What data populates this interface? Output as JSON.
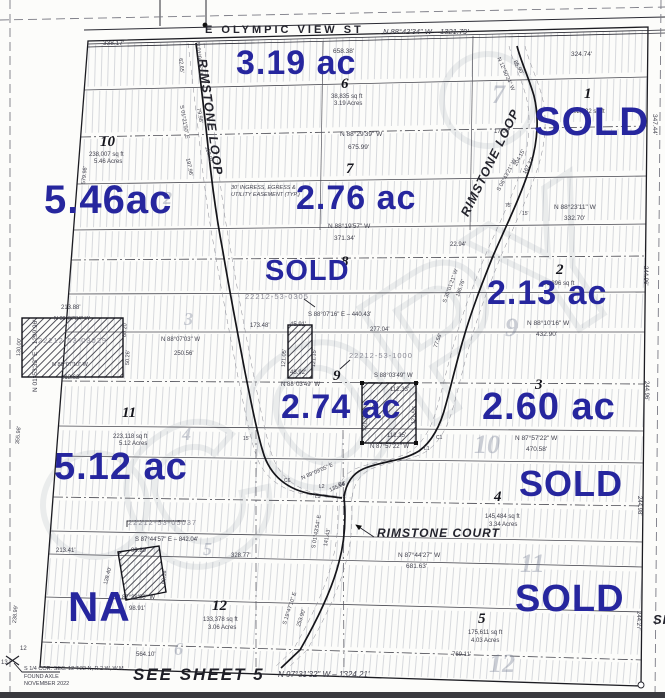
{
  "map": {
    "watermark": "COPY",
    "colors": {
      "annotation_blue": "#26269e",
      "line_dark": "#23232c",
      "hatch_gray": "#9aa0ad"
    },
    "streets": {
      "top_street": "E OLYMPIC VIEW ST",
      "loop": "RIMSTONE LOOP",
      "court": "RIMSTONE COURT"
    },
    "acreage_notes": [
      {
        "t": "3.19 ac",
        "x": 236,
        "y": 46,
        "s": 34
      },
      {
        "t": "SOLD",
        "x": 534,
        "y": 102,
        "s": 40
      },
      {
        "t": "5.46ac",
        "x": 44,
        "y": 180,
        "s": 40
      },
      {
        "t": "2.76 ac",
        "x": 296,
        "y": 181,
        "s": 34
      },
      {
        "t": "SOLD",
        "x": 265,
        "y": 257,
        "s": 29
      },
      {
        "t": "2.13 ac",
        "x": 487,
        "y": 276,
        "s": 34
      },
      {
        "t": "2.74 ac",
        "x": 281,
        "y": 390,
        "s": 34
      },
      {
        "t": "2.60 ac",
        "x": 482,
        "y": 388,
        "s": 38
      },
      {
        "t": "5.12 ac",
        "x": 54,
        "y": 448,
        "s": 38
      },
      {
        "t": "SOLD",
        "x": 519,
        "y": 466,
        "s": 36
      },
      {
        "t": "NA",
        "x": 68,
        "y": 586,
        "s": 42
      },
      {
        "t": "SOLD",
        "x": 515,
        "y": 580,
        "s": 38
      }
    ],
    "lot_numbers": [
      {
        "t": "10",
        "x": 100,
        "y": 135,
        "s": 15
      },
      {
        "t": "6",
        "x": 341,
        "y": 77,
        "s": 15
      },
      {
        "t": "1",
        "x": 584,
        "y": 87,
        "s": 15
      },
      {
        "t": "7",
        "x": 346,
        "y": 162,
        "s": 15
      },
      {
        "t": "8",
        "x": 341,
        "y": 255,
        "s": 15
      },
      {
        "t": "2",
        "x": 556,
        "y": 263,
        "s": 15
      },
      {
        "t": "9",
        "x": 333,
        "y": 369,
        "s": 15
      },
      {
        "t": "3",
        "x": 535,
        "y": 378,
        "s": 15
      },
      {
        "t": "11",
        "x": 122,
        "y": 406,
        "s": 15
      },
      {
        "t": "4",
        "x": 494,
        "y": 490,
        "s": 15
      },
      {
        "t": "12",
        "x": 212,
        "y": 599,
        "s": 15
      },
      {
        "t": "5",
        "x": 478,
        "y": 612,
        "s": 15
      }
    ],
    "ghost_numbers": [
      {
        "t": "7",
        "x": 492,
        "y": 82,
        "s": 26
      },
      {
        "t": "9",
        "x": 505,
        "y": 315,
        "s": 26
      },
      {
        "t": "10",
        "x": 474,
        "y": 432,
        "s": 26
      },
      {
        "t": "11",
        "x": 520,
        "y": 551,
        "s": 26
      },
      {
        "t": "12",
        "x": 489,
        "y": 651,
        "s": 26
      },
      {
        "t": "2",
        "x": 163,
        "y": 189,
        "s": 18
      },
      {
        "t": "3",
        "x": 184,
        "y": 310,
        "s": 18
      },
      {
        "t": "4",
        "x": 182,
        "y": 425,
        "s": 18
      },
      {
        "t": "5",
        "x": 203,
        "y": 540,
        "s": 18
      },
      {
        "t": "6",
        "x": 174,
        "y": 640,
        "s": 18
      }
    ],
    "labels": [
      {
        "t": "E OLYMPIC VIEW ST",
        "x": 205,
        "y": 25,
        "s": 11,
        "c": "street"
      },
      {
        "t": "N 88°42'34\" W – 1321.79'",
        "x": 383,
        "y": 28,
        "s": 7.5,
        "c": "it"
      },
      {
        "t": "338.17'",
        "x": 103,
        "y": 41,
        "s": 6.5
      },
      {
        "t": "658.38'",
        "x": 333,
        "y": 49,
        "s": 6.5
      },
      {
        "t": "324.74'",
        "x": 571,
        "y": 52,
        "s": 6.5
      },
      {
        "t": "347.44'",
        "x": 657,
        "y": 114,
        "s": 6.5,
        "r": 90
      },
      {
        "t": "RIMSTONE LOOP",
        "x": 208,
        "y": 58,
        "s": 12.5,
        "r": 82,
        "c": "roadname"
      },
      {
        "t": "RIMSTONE LOOP",
        "x": 459,
        "y": 213,
        "s": 12.5,
        "r": -64,
        "c": "roadname"
      },
      {
        "t": "62.65'",
        "x": 182,
        "y": 58,
        "s": 5.5,
        "r": 84
      },
      {
        "t": "N 01°01'17\" E",
        "x": 199,
        "y": 42,
        "s": 5.5,
        "r": 84
      },
      {
        "t": "S 01°21'50\" E",
        "x": 183,
        "y": 105,
        "s": 5.5,
        "r": 80
      },
      {
        "t": "79.98'",
        "x": 200,
        "y": 108,
        "s": 5.5,
        "r": 80
      },
      {
        "t": "118.01'",
        "x": 208,
        "y": 146,
        "s": 5.5,
        "r": 74
      },
      {
        "t": "197.96'",
        "x": 189,
        "y": 158,
        "s": 5.5,
        "r": 78
      },
      {
        "t": "N 12°50'24\" W",
        "x": 500,
        "y": 57,
        "s": 5.5,
        "r": 66
      },
      {
        "t": "86.90'",
        "x": 516,
        "y": 60,
        "s": 5.5,
        "r": 60
      },
      {
        "t": "17.00'",
        "x": 494,
        "y": 129,
        "s": 6
      },
      {
        "t": "204.15'",
        "x": 514,
        "y": 165,
        "s": 5.5,
        "r": -62
      },
      {
        "t": "167.32'",
        "x": 523,
        "y": 173,
        "s": 5.5,
        "r": -62
      },
      {
        "t": "S 06°43'21\" W",
        "x": 497,
        "y": 190,
        "s": 5.5,
        "r": -62
      },
      {
        "t": "75'",
        "x": 505,
        "y": 204,
        "s": 5
      },
      {
        "t": "15'",
        "x": 522,
        "y": 212,
        "s": 5
      },
      {
        "t": "38,835 sq ft",
        "x": 331,
        "y": 94,
        "s": 6
      },
      {
        "t": "3.19 Acres",
        "x": 334,
        "y": 101,
        "s": 6
      },
      {
        "t": "102,732 sq ft",
        "x": 570,
        "y": 109,
        "s": 6
      },
      {
        "t": "238,007 sq ft",
        "x": 89,
        "y": 152,
        "s": 6
      },
      {
        "t": "5.46 Acres",
        "x": 94,
        "y": 159,
        "s": 6
      },
      {
        "t": "N 88°29'39\" W",
        "x": 340,
        "y": 132,
        "s": 6.5
      },
      {
        "t": "675.99'",
        "x": 348,
        "y": 145,
        "s": 6.5
      },
      {
        "t": "30' INGRESS, EGRESS &",
        "x": 231,
        "y": 186,
        "s": 5.5,
        "c": "it"
      },
      {
        "t": "UTILITY EASEMENT (TYP.)",
        "x": 231,
        "y": 193,
        "s": 5.5,
        "c": "it"
      },
      {
        "t": "N 88°19'57\" W",
        "x": 328,
        "y": 224,
        "s": 6.5
      },
      {
        "t": "371.34'",
        "x": 334,
        "y": 236,
        "s": 6.5
      },
      {
        "t": "N 88°23'11\" W",
        "x": 554,
        "y": 205,
        "s": 6.5
      },
      {
        "t": "332.70'",
        "x": 564,
        "y": 216,
        "s": 6.5
      },
      {
        "t": "22.94'",
        "x": 450,
        "y": 242,
        "s": 6
      },
      {
        "t": "91,896 sq ft",
        "x": 543,
        "y": 281,
        "s": 6
      },
      {
        "t": "S 35°01'21\" W",
        "x": 443,
        "y": 302,
        "s": 5.5,
        "r": -70
      },
      {
        "t": "186.76'",
        "x": 456,
        "y": 296,
        "s": 5.5,
        "r": -70
      },
      {
        "t": "77.56'",
        "x": 434,
        "y": 347,
        "s": 5.5,
        "r": -70
      },
      {
        "t": "N 01°53'33\" E – 1299.96'",
        "x": 33,
        "y": 392,
        "s": 6.5,
        "r": -90
      },
      {
        "t": "579.98'",
        "x": 82,
        "y": 184,
        "s": 5.5,
        "r": -84
      },
      {
        "t": "213.88'",
        "x": 61,
        "y": 305,
        "s": 6
      },
      {
        "t": "N 88°07'34\" W",
        "x": 54,
        "y": 317,
        "s": 5.5
      },
      {
        "t": "22212-53-03029",
        "x": 38,
        "y": 337,
        "s": 7.5,
        "c": "gray"
      },
      {
        "t": "N 88°07'10\" W",
        "x": 52,
        "y": 363,
        "s": 5.5
      },
      {
        "t": "213.62'",
        "x": 61,
        "y": 375,
        "s": 6
      },
      {
        "t": "130.00'",
        "x": 17,
        "y": 356,
        "s": 5.5,
        "r": -87
      },
      {
        "t": "N 88°07'03\" W",
        "x": 161,
        "y": 337,
        "s": 6
      },
      {
        "t": "250.56'",
        "x": 174,
        "y": 351,
        "s": 6
      },
      {
        "t": "60.20'",
        "x": 123,
        "y": 337,
        "s": 5.5,
        "r": -88
      },
      {
        "t": "50.26'",
        "x": 126,
        "y": 365,
        "s": 5.5,
        "r": -88
      },
      {
        "t": "173.48'",
        "x": 250,
        "y": 323,
        "s": 6
      },
      {
        "t": "45.91'",
        "x": 290,
        "y": 322,
        "s": 6
      },
      {
        "t": "S 88°07'16\" E – 440.43'",
        "x": 308,
        "y": 312,
        "s": 6
      },
      {
        "t": "277.04'",
        "x": 370,
        "y": 327,
        "s": 6
      },
      {
        "t": "22212-53-0305",
        "x": 245,
        "y": 293,
        "s": 7.5,
        "c": "gray"
      },
      {
        "t": "121.05'",
        "x": 282,
        "y": 367,
        "s": 5.5,
        "r": -87
      },
      {
        "t": "121.15'",
        "x": 312,
        "y": 367,
        "s": 5.5,
        "r": -87
      },
      {
        "t": "48.92'",
        "x": 290,
        "y": 370,
        "s": 6
      },
      {
        "t": "22212-53-1000",
        "x": 349,
        "y": 352,
        "s": 7.5,
        "c": "gray"
      },
      {
        "t": "N 88°03'49\" W",
        "x": 281,
        "y": 382,
        "s": 6
      },
      {
        "t": "S 88°03'49\" W",
        "x": 374,
        "y": 373,
        "s": 6
      },
      {
        "t": "112.33'",
        "x": 390,
        "y": 387,
        "s": 6
      },
      {
        "t": "121.36'",
        "x": 363,
        "y": 431,
        "s": 5.5,
        "r": -87
      },
      {
        "t": "121.50'",
        "x": 412,
        "y": 424,
        "s": 5.5,
        "r": -87
      },
      {
        "t": "112.35'",
        "x": 387,
        "y": 433,
        "s": 6
      },
      {
        "t": "N 87°57'22\" W",
        "x": 370,
        "y": 444,
        "s": 6
      },
      {
        "t": "N 88°10'16\" W",
        "x": 527,
        "y": 321,
        "s": 6.5
      },
      {
        "t": "432.90'",
        "x": 536,
        "y": 332,
        "s": 6.5
      },
      {
        "t": "244.96'",
        "x": 648,
        "y": 266,
        "s": 6,
        "r": 90
      },
      {
        "t": "244.96'",
        "x": 649,
        "y": 381,
        "s": 6,
        "r": 90
      },
      {
        "t": "244.98'",
        "x": 642,
        "y": 496,
        "s": 6,
        "r": 90
      },
      {
        "t": "244.27'",
        "x": 641,
        "y": 611,
        "s": 6,
        "r": 90
      },
      {
        "t": "223,118 sq ft",
        "x": 113,
        "y": 434,
        "s": 6
      },
      {
        "t": "5.12 Acres",
        "x": 119,
        "y": 441,
        "s": 6
      },
      {
        "t": "355.98'",
        "x": 16,
        "y": 444,
        "s": 5.5,
        "r": -85
      },
      {
        "t": "22212-53-05037",
        "x": 128,
        "y": 519,
        "s": 7.5,
        "c": "gray"
      },
      {
        "t": "S 87°44'57\" E – 842.04'",
        "x": 135,
        "y": 537,
        "s": 6
      },
      {
        "t": "213.41'",
        "x": 56,
        "y": 548,
        "s": 6
      },
      {
        "t": "99.89'",
        "x": 131,
        "y": 548,
        "s": 6
      },
      {
        "t": "328.77'",
        "x": 231,
        "y": 553,
        "s": 6
      },
      {
        "t": "128.40'",
        "x": 104,
        "y": 584,
        "s": 5.5,
        "r": -75
      },
      {
        "t": "60.58'",
        "x": 162,
        "y": 584,
        "s": 5.5,
        "r": -85
      },
      {
        "t": "N 87°38'00\" W",
        "x": 116,
        "y": 595,
        "s": 6
      },
      {
        "t": "98.91'",
        "x": 129,
        "y": 606,
        "s": 6
      },
      {
        "t": "238.99'",
        "x": 13,
        "y": 623,
        "s": 5.5,
        "r": -85
      },
      {
        "t": "133,378 sq ft",
        "x": 203,
        "y": 617,
        "s": 6
      },
      {
        "t": "3.06 Acres",
        "x": 208,
        "y": 625,
        "s": 6
      },
      {
        "t": "564.10'",
        "x": 136,
        "y": 652,
        "s": 6
      },
      {
        "t": "SEE SHEET 5",
        "x": 133,
        "y": 666,
        "s": 17,
        "c": "sheet"
      },
      {
        "t": "S 1/4 COR. SEC. 12 T.22 N, R 2 W, W.M.",
        "x": 24,
        "y": 667,
        "s": 5.5
      },
      {
        "t": "FOUND AXLE",
        "x": 24,
        "y": 675,
        "s": 5.5
      },
      {
        "t": "NOVEMBER 2022",
        "x": 24,
        "y": 682,
        "s": 5.5
      },
      {
        "t": "N 97°31'32\" W – 1324.21'",
        "x": 278,
        "y": 671,
        "s": 8,
        "c": "it"
      },
      {
        "t": "RIMSTONE COURT",
        "x": 377,
        "y": 527,
        "s": 12,
        "c": "roadname"
      },
      {
        "t": "S 19°47'10\" E",
        "x": 283,
        "y": 624,
        "s": 5.5,
        "r": -72
      },
      {
        "t": "253.90'",
        "x": 297,
        "y": 626,
        "s": 5.5,
        "r": -72
      },
      {
        "t": "N 89°09'05\" E",
        "x": 301,
        "y": 477,
        "s": 5.5,
        "r": -24
      },
      {
        "t": "135.86'",
        "x": 329,
        "y": 489,
        "s": 5.5,
        "r": -24
      },
      {
        "t": "N 87°57'22\" W",
        "x": 515,
        "y": 436,
        "s": 6.5
      },
      {
        "t": "470.58'",
        "x": 526,
        "y": 447,
        "s": 6.5
      },
      {
        "t": "145,484 sq ft",
        "x": 485,
        "y": 514,
        "s": 6
      },
      {
        "t": "3.34 Acres",
        "x": 489,
        "y": 522,
        "s": 6
      },
      {
        "t": "N 87°44'27\" W",
        "x": 398,
        "y": 553,
        "s": 6.5
      },
      {
        "t": "681.63'",
        "x": 406,
        "y": 564,
        "s": 6.5
      },
      {
        "t": "175,611 sq ft",
        "x": 468,
        "y": 630,
        "s": 6
      },
      {
        "t": "4.03 Acres",
        "x": 471,
        "y": 638,
        "s": 6
      },
      {
        "t": "769.11'",
        "x": 452,
        "y": 652,
        "s": 6
      },
      {
        "t": "S 01°43'54\" E",
        "x": 312,
        "y": 548,
        "s": 5.5,
        "r": -80
      },
      {
        "t": "141.43'",
        "x": 324,
        "y": 546,
        "s": 5.5,
        "r": -80
      },
      {
        "t": "C4",
        "x": 338,
        "y": 483,
        "s": 5
      },
      {
        "t": "L2",
        "x": 319,
        "y": 485,
        "s": 5
      },
      {
        "t": "L3",
        "x": 315,
        "y": 495,
        "s": 5
      },
      {
        "t": "C6",
        "x": 284,
        "y": 479,
        "s": 5
      },
      {
        "t": "L1",
        "x": 424,
        "y": 447,
        "s": 5
      },
      {
        "t": "C1",
        "x": 436,
        "y": 436,
        "s": 5
      },
      {
        "t": "15'",
        "x": 243,
        "y": 437,
        "s": 5
      },
      {
        "t": "SI",
        "x": 653,
        "y": 613,
        "s": 13,
        "c": "roadname"
      },
      {
        "t": "12",
        "x": 20,
        "y": 646,
        "s": 6
      },
      {
        "t": "13",
        "x": 1,
        "y": 660,
        "s": 6
      }
    ]
  }
}
